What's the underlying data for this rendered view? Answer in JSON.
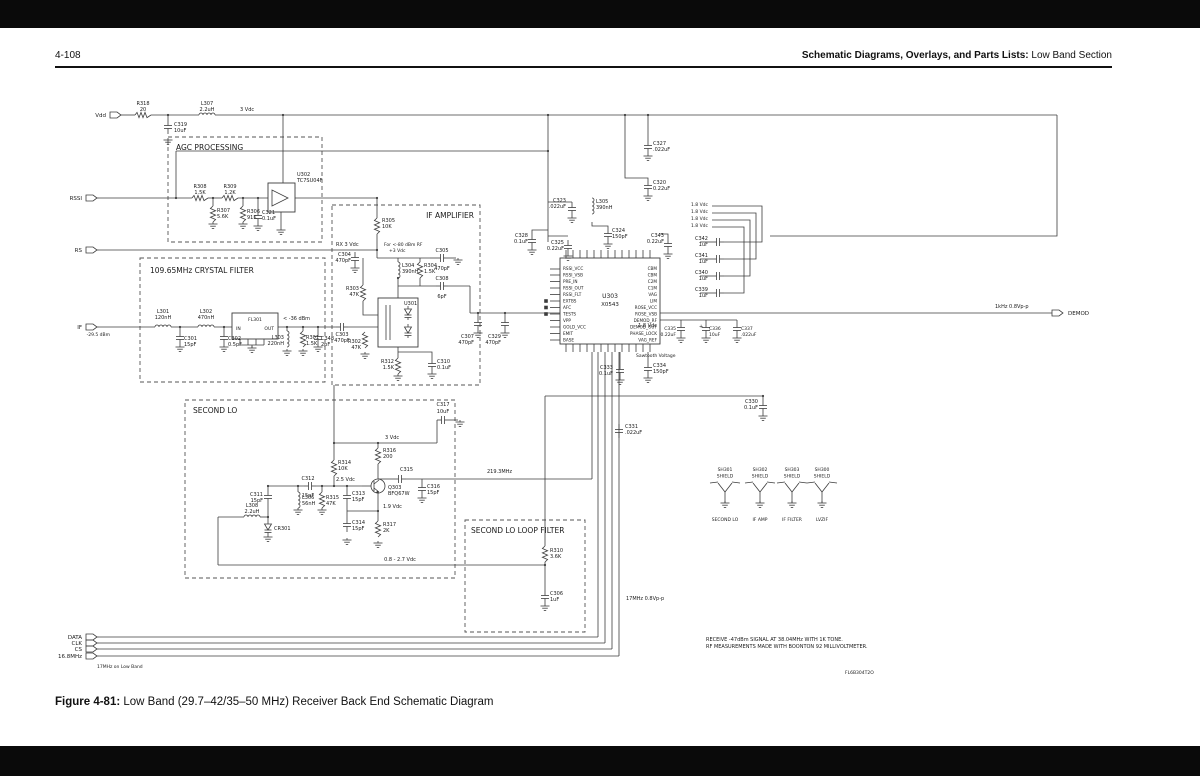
{
  "header": {
    "page_number": "4-108",
    "title_bold": "Schematic Diagrams, Overlays, and Parts Lists:",
    "title_regular": " Low Band Section"
  },
  "caption": {
    "bold": "Figure 4-81:",
    "text": " Low Band (29.7–42/35–50 MHz) Receiver Back End Schematic Diagram"
  },
  "schematic": {
    "blocks": [
      {
        "t": "AGC PROCESSING",
        "x": 168,
        "y": 137,
        "w": 154,
        "h": 105,
        "tx": 176,
        "ty": 150
      },
      {
        "t": "IF AMPLIFIER",
        "x": 332,
        "y": 205,
        "w": 148,
        "h": 180,
        "tx": 474,
        "ty": 218,
        "ta": "end"
      },
      {
        "t": "109.65MHz CRYSTAL FILTER",
        "x": 140,
        "y": 258,
        "w": 185,
        "h": 124,
        "tx": 150,
        "ty": 273
      },
      {
        "t": "SECOND LO",
        "x": 185,
        "y": 400,
        "w": 270,
        "h": 178,
        "tx": 193,
        "ty": 413
      },
      {
        "t": "SECOND LO LOOP FILTER",
        "x": 465,
        "y": 520,
        "w": 120,
        "h": 112,
        "tx": 471,
        "ty": 533
      }
    ],
    "connectors": [
      {
        "t": "Vdd",
        "x": 110,
        "y": 115
      },
      {
        "t": "RSSI",
        "x": 86,
        "y": 198
      },
      {
        "t": "RS",
        "x": 86,
        "y": 250
      },
      {
        "t": "IF",
        "x": 86,
        "y": 327,
        "sub": "-29.5 dBm"
      },
      {
        "t": "DATA",
        "x": 86,
        "y": 637
      },
      {
        "t": "CLK",
        "x": 86,
        "y": 643
      },
      {
        "t": "CS",
        "x": 86,
        "y": 649
      },
      {
        "t": "16.8MHz",
        "x": 86,
        "y": 656
      },
      {
        "t": "DEMOD",
        "x": 1052,
        "y": 313,
        "out": true
      }
    ],
    "ic": {
      "ref": "U303",
      "part": "X0543",
      "left": [
        "RSSI_VCC",
        "RSSI_VSB",
        "PRE_IN",
        "RSSI_OUT",
        "RSSI_FLT",
        "EXTBS",
        "AFC",
        "TESTS",
        "VPP",
        "GOLD_VCC",
        "EMIT",
        "BASE"
      ],
      "right": [
        "CBM",
        "CBM",
        "C2M",
        "C1M",
        "VAG",
        "LIM",
        "ROSE_VCC",
        "ROSE_VSB",
        "DEMOD_RF",
        "DEMOD_OUT",
        "PHASE_LOCK",
        "VAG_REF"
      ]
    },
    "labels": [
      {
        "t": "R318",
        "x": 143,
        "y": 105,
        "a": "m"
      },
      {
        "t": "20",
        "x": 143,
        "y": 111,
        "a": "m"
      },
      {
        "t": "L307",
        "x": 207,
        "y": 105,
        "a": "m"
      },
      {
        "t": "2.2uH",
        "x": 207,
        "y": 111,
        "a": "m"
      },
      {
        "t": "3 Vdc",
        "x": 240,
        "y": 111
      },
      {
        "t": "C319",
        "x": 174,
        "y": 126
      },
      {
        "t": "10uF",
        "x": 174,
        "y": 132
      },
      {
        "t": "R308",
        "x": 200,
        "y": 188,
        "a": "m"
      },
      {
        "t": "1.5K",
        "x": 200,
        "y": 194,
        "a": "m"
      },
      {
        "t": "R309",
        "x": 230,
        "y": 188,
        "a": "m"
      },
      {
        "t": "1.2K",
        "x": 230,
        "y": 194,
        "a": "m"
      },
      {
        "t": "R307",
        "x": 217,
        "y": 212
      },
      {
        "t": "5.6K",
        "x": 217,
        "y": 218
      },
      {
        "t": "R306",
        "x": 247,
        "y": 213
      },
      {
        "t": "91K",
        "x": 247,
        "y": 219
      },
      {
        "t": "C321",
        "x": 262,
        "y": 214
      },
      {
        "t": "0.1uF",
        "x": 262,
        "y": 220
      },
      {
        "t": "U302",
        "x": 297,
        "y": 176
      },
      {
        "t": "TC7SU04F",
        "x": 297,
        "y": 182
      },
      {
        "t": "R305",
        "x": 382,
        "y": 222
      },
      {
        "t": "10K",
        "x": 382,
        "y": 228
      },
      {
        "t": "C304",
        "x": 351,
        "y": 256,
        "a": "e"
      },
      {
        "t": "470pF",
        "x": 351,
        "y": 262,
        "a": "e"
      },
      {
        "t": "RX 3 Vdc",
        "x": 336,
        "y": 246
      },
      {
        "t": "For <-80 dBm RF",
        "x": 384,
        "y": 246,
        "s": 4.5
      },
      {
        "t": "+3 Vdc",
        "x": 389,
        "y": 252,
        "s": 4.5
      },
      {
        "t": "L304",
        "x": 402,
        "y": 267
      },
      {
        "t": "390nH",
        "x": 402,
        "y": 273
      },
      {
        "t": "R304",
        "x": 424,
        "y": 267
      },
      {
        "t": "1.5K",
        "x": 424,
        "y": 273
      },
      {
        "t": "C305",
        "x": 442,
        "y": 252,
        "a": "m"
      },
      {
        "t": "470pF",
        "x": 442,
        "y": 270,
        "a": "m"
      },
      {
        "t": "C308",
        "x": 442,
        "y": 280,
        "a": "m"
      },
      {
        "t": "6pF",
        "x": 442,
        "y": 298,
        "a": "m"
      },
      {
        "t": "R303",
        "x": 359,
        "y": 290,
        "a": "e"
      },
      {
        "t": "47K",
        "x": 359,
        "y": 296,
        "a": "e"
      },
      {
        "t": "C303",
        "x": 342,
        "y": 336,
        "a": "m"
      },
      {
        "t": "470pF",
        "x": 342,
        "y": 342,
        "a": "m"
      },
      {
        "t": "R302",
        "x": 361,
        "y": 343,
        "a": "e"
      },
      {
        "t": "47K",
        "x": 361,
        "y": 349,
        "a": "e"
      },
      {
        "t": "U301",
        "x": 404,
        "y": 305
      },
      {
        "t": "R312",
        "x": 394,
        "y": 363,
        "a": "e"
      },
      {
        "t": "1.5K",
        "x": 394,
        "y": 369,
        "a": "e"
      },
      {
        "t": "C310",
        "x": 437,
        "y": 363
      },
      {
        "t": "0.1uF",
        "x": 437,
        "y": 369
      },
      {
        "t": "L301",
        "x": 163,
        "y": 313,
        "a": "m"
      },
      {
        "t": "120nH",
        "x": 163,
        "y": 319,
        "a": "m"
      },
      {
        "t": "C301",
        "x": 184,
        "y": 340
      },
      {
        "t": "15pF",
        "x": 184,
        "y": 346
      },
      {
        "t": "L302",
        "x": 206,
        "y": 313,
        "a": "m"
      },
      {
        "t": "470nH",
        "x": 206,
        "y": 319,
        "a": "m"
      },
      {
        "t": "C302",
        "x": 228,
        "y": 340
      },
      {
        "t": "0.5pF",
        "x": 228,
        "y": 346
      },
      {
        "t": "FL301",
        "x": 255,
        "y": 321,
        "a": "m",
        "s": 4.5
      },
      {
        "t": "IN",
        "x": 236,
        "y": 330,
        "s": 4.5
      },
      {
        "t": "OUT",
        "x": 274,
        "y": 330,
        "a": "e",
        "s": 4.5
      },
      {
        "t": "< -36 dBm",
        "x": 283,
        "y": 320
      },
      {
        "t": "L303",
        "x": 284,
        "y": 339,
        "a": "e"
      },
      {
        "t": "220nH",
        "x": 284,
        "y": 345,
        "a": "e"
      },
      {
        "t": "R301",
        "x": 306,
        "y": 339
      },
      {
        "t": "1.5K",
        "x": 306,
        "y": 345
      },
      {
        "t": "C348",
        "x": 321,
        "y": 340
      },
      {
        "t": "2pF",
        "x": 321,
        "y": 346
      },
      {
        "t": "C307",
        "x": 474,
        "y": 338,
        "a": "e"
      },
      {
        "t": "470pF",
        "x": 474,
        "y": 344,
        "a": "e"
      },
      {
        "t": "C329",
        "x": 501,
        "y": 338,
        "a": "e"
      },
      {
        "t": "470pF",
        "x": 501,
        "y": 344,
        "a": "e"
      },
      {
        "t": "C327",
        "x": 653,
        "y": 145
      },
      {
        "t": ".022uF",
        "x": 653,
        "y": 151
      },
      {
        "t": "C320",
        "x": 653,
        "y": 184
      },
      {
        "t": "0.22uF",
        "x": 653,
        "y": 190
      },
      {
        "t": "C323",
        "x": 566,
        "y": 202,
        "a": "e"
      },
      {
        "t": ".022uF",
        "x": 566,
        "y": 208,
        "a": "e"
      },
      {
        "t": "L305",
        "x": 596,
        "y": 203
      },
      {
        "t": "390nH",
        "x": 596,
        "y": 209
      },
      {
        "t": "C324",
        "x": 612,
        "y": 232
      },
      {
        "t": "150pF",
        "x": 612,
        "y": 238
      },
      {
        "t": "C325",
        "x": 564,
        "y": 244,
        "a": "e"
      },
      {
        "t": "0.22uF",
        "x": 564,
        "y": 250,
        "a": "e"
      },
      {
        "t": "C328",
        "x": 528,
        "y": 237,
        "a": "e"
      },
      {
        "t": "0.1uF",
        "x": 528,
        "y": 243,
        "a": "e"
      },
      {
        "t": "1.8 Vdc",
        "x": 708,
        "y": 206,
        "a": "e",
        "s": 4.5
      },
      {
        "t": "1.8 Vdc",
        "x": 708,
        "y": 213,
        "a": "e",
        "s": 4.5
      },
      {
        "t": "1.8 Vdc",
        "x": 708,
        "y": 220,
        "a": "e",
        "s": 4.5
      },
      {
        "t": "1.8 Vdc",
        "x": 708,
        "y": 227,
        "a": "e",
        "s": 4.5
      },
      {
        "t": "C343",
        "x": 664,
        "y": 237,
        "a": "e"
      },
      {
        "t": "0.22uF",
        "x": 664,
        "y": 243,
        "a": "e"
      },
      {
        "t": "C342",
        "x": 708,
        "y": 240,
        "a": "e"
      },
      {
        "t": "1uF",
        "x": 708,
        "y": 246,
        "a": "e"
      },
      {
        "t": "C341",
        "x": 708,
        "y": 257,
        "a": "e"
      },
      {
        "t": "1uF",
        "x": 708,
        "y": 263,
        "a": "e"
      },
      {
        "t": "C340",
        "x": 708,
        "y": 274,
        "a": "e"
      },
      {
        "t": "1uF",
        "x": 708,
        "y": 280,
        "a": "e"
      },
      {
        "t": "C339",
        "x": 708,
        "y": 291,
        "a": "e"
      },
      {
        "t": "1uF",
        "x": 708,
        "y": 297,
        "a": "e"
      },
      {
        "t": "1.8 Vdc",
        "x": 657,
        "y": 327,
        "a": "e"
      },
      {
        "t": "C335",
        "x": 676,
        "y": 330,
        "a": "e",
        "s": 4.5
      },
      {
        "t": "0.22uF",
        "x": 676,
        "y": 336,
        "a": "e",
        "s": 4.5
      },
      {
        "t": "+",
        "x": 699,
        "y": 328,
        "s": 5
      },
      {
        "t": "C336",
        "x": 709,
        "y": 330,
        "s": 4.5
      },
      {
        "t": "10uF",
        "x": 709,
        "y": 336,
        "s": 4.5
      },
      {
        "t": "C337",
        "x": 741,
        "y": 330,
        "s": 4.5
      },
      {
        "t": ".022uF",
        "x": 741,
        "y": 336,
        "s": 4.5
      },
      {
        "t": "1kHz 0.8Vp-p",
        "x": 995,
        "y": 308
      },
      {
        "t": "Sawtooth Voltage",
        "x": 636,
        "y": 357,
        "s": 4.5
      },
      {
        "t": "C333",
        "x": 613,
        "y": 369,
        "a": "e"
      },
      {
        "t": "0.1uF",
        "x": 613,
        "y": 375,
        "a": "e"
      },
      {
        "t": "C334",
        "x": 653,
        "y": 367
      },
      {
        "t": "150pF",
        "x": 653,
        "y": 373
      },
      {
        "t": "C330",
        "x": 758,
        "y": 403,
        "a": "e"
      },
      {
        "t": "0.1uF",
        "x": 758,
        "y": 409,
        "a": "e"
      },
      {
        "t": "C331",
        "x": 625,
        "y": 428
      },
      {
        "t": ".022uF",
        "x": 625,
        "y": 434
      },
      {
        "t": "17MHz 0.8Vp-p",
        "x": 626,
        "y": 600
      },
      {
        "t": "219.3MHz",
        "x": 487,
        "y": 473
      },
      {
        "t": "C317",
        "x": 443,
        "y": 406,
        "a": "m"
      },
      {
        "t": "10uF",
        "x": 443,
        "y": 413,
        "a": "m"
      },
      {
        "t": "3 Vdc",
        "x": 385,
        "y": 439
      },
      {
        "t": "R316",
        "x": 383,
        "y": 452
      },
      {
        "t": "200",
        "x": 383,
        "y": 458
      },
      {
        "t": "C315",
        "x": 400,
        "y": 471
      },
      {
        "t": "Q303",
        "x": 388,
        "y": 489
      },
      {
        "t": "BFQ67W",
        "x": 388,
        "y": 495
      },
      {
        "t": "C316",
        "x": 427,
        "y": 488
      },
      {
        "t": "15pF",
        "x": 427,
        "y": 494
      },
      {
        "t": "R314",
        "x": 338,
        "y": 464
      },
      {
        "t": "10K",
        "x": 338,
        "y": 470
      },
      {
        "t": "2.5 Vdc",
        "x": 336,
        "y": 481
      },
      {
        "t": "C312",
        "x": 308,
        "y": 480,
        "a": "m"
      },
      {
        "t": "15pF",
        "x": 308,
        "y": 497,
        "a": "m"
      },
      {
        "t": "C311",
        "x": 263,
        "y": 496,
        "a": "e"
      },
      {
        "t": "15pF",
        "x": 263,
        "y": 502,
        "a": "e"
      },
      {
        "t": "L306",
        "x": 302,
        "y": 499
      },
      {
        "t": "56nH",
        "x": 302,
        "y": 505
      },
      {
        "t": "R315",
        "x": 326,
        "y": 499
      },
      {
        "t": "47K",
        "x": 326,
        "y": 505
      },
      {
        "t": "C313",
        "x": 352,
        "y": 495
      },
      {
        "t": "15pF",
        "x": 352,
        "y": 501
      },
      {
        "t": "C314",
        "x": 352,
        "y": 524
      },
      {
        "t": "15pF",
        "x": 352,
        "y": 530
      },
      {
        "t": "R317",
        "x": 383,
        "y": 526
      },
      {
        "t": "2K",
        "x": 383,
        "y": 532
      },
      {
        "t": "1.9 Vdc",
        "x": 383,
        "y": 508
      },
      {
        "t": "L308",
        "x": 252,
        "y": 507,
        "a": "m"
      },
      {
        "t": "2.2uH",
        "x": 252,
        "y": 513,
        "a": "m"
      },
      {
        "t": "CR301",
        "x": 274,
        "y": 530
      },
      {
        "t": "0.8 - 2.7 Vdc",
        "x": 400,
        "y": 561,
        "a": "m"
      },
      {
        "t": "R310",
        "x": 550,
        "y": 552
      },
      {
        "t": "3.6K",
        "x": 550,
        "y": 558
      },
      {
        "t": "C306",
        "x": 550,
        "y": 595
      },
      {
        "t": "1uF",
        "x": 550,
        "y": 601
      },
      {
        "t": "17MHz on Low Band",
        "x": 97,
        "y": 668,
        "s": 4.5
      }
    ],
    "shields": {
      "shield_word": "SHIELD",
      "items": [
        {
          "ref": "SH301",
          "name": "SECOND LO",
          "x": 725
        },
        {
          "ref": "SH302",
          "name": "IF AMP",
          "x": 760
        },
        {
          "ref": "SH303",
          "name": "IF FILTER",
          "x": 792
        },
        {
          "ref": "SH300",
          "name": "LVZIF",
          "x": 822
        }
      ]
    },
    "notes": {
      "lines": [
        "RECEIVE -47dBm SIGNAL AT 38.04MHz WITH 1K TONE.",
        "RF MEASUREMENTS MADE WITH BOONTON 92 MILLIVOLTMETER."
      ],
      "x": 706,
      "y": 641,
      "code": "FL6B304T2O",
      "code_x": 845,
      "code_y": 674
    }
  }
}
